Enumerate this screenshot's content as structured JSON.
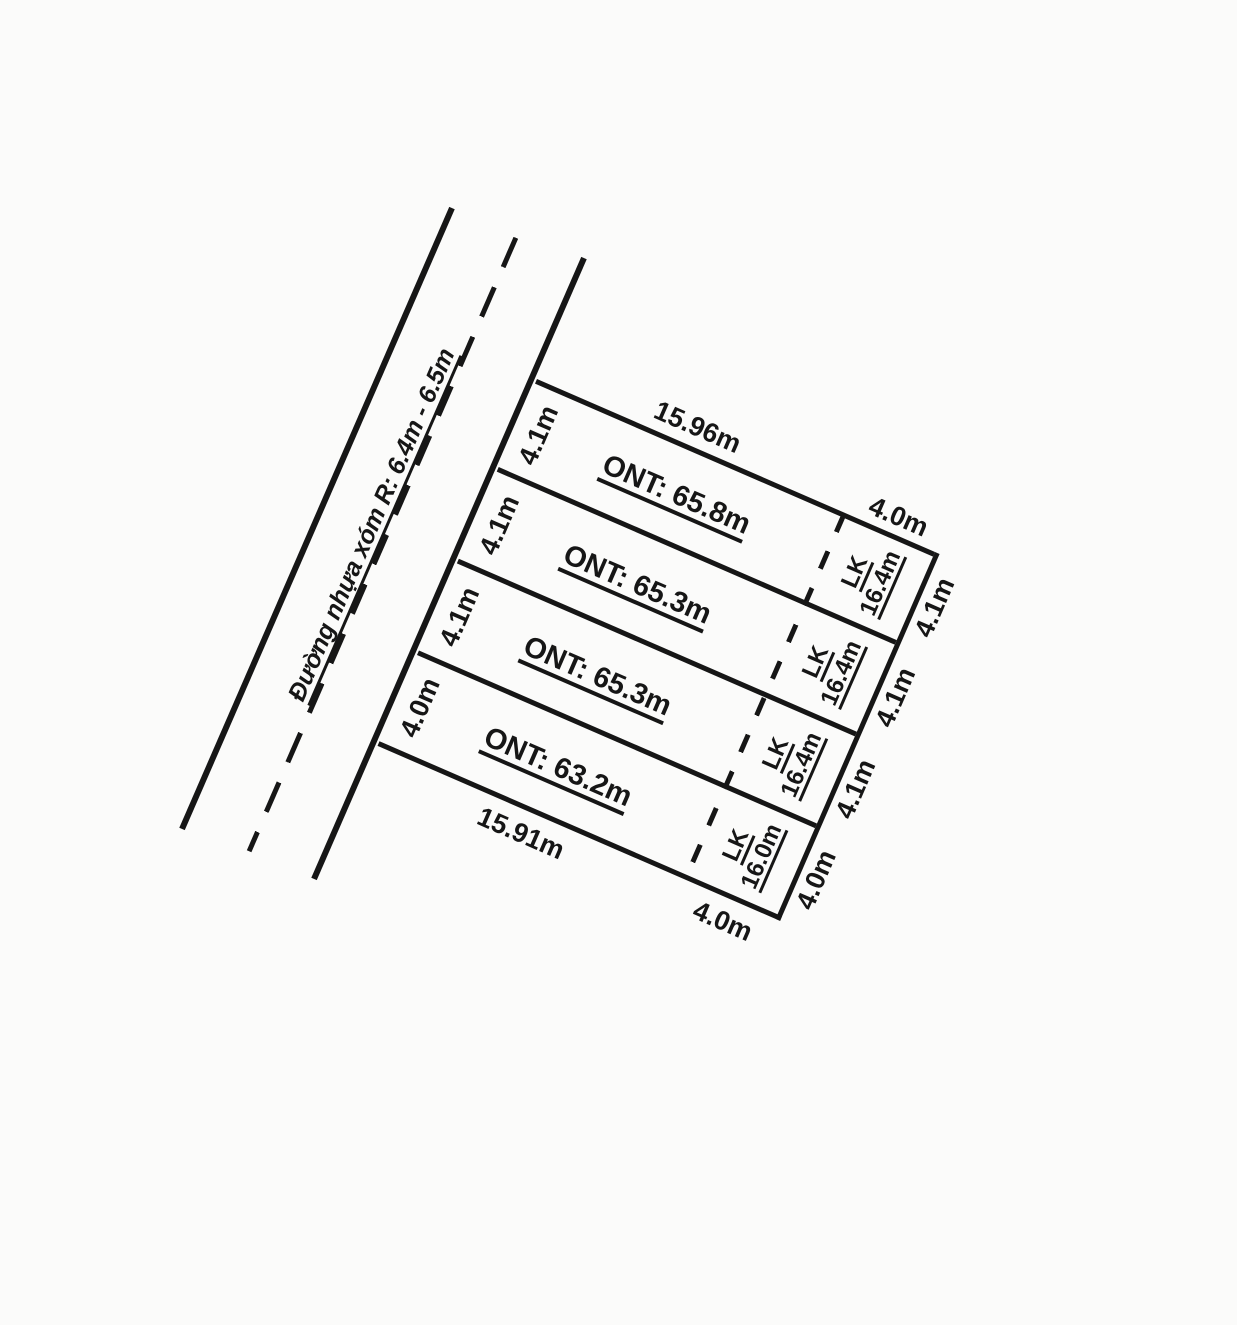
{
  "scene": {
    "background": "#fbfbfa",
    "ink": "#161616",
    "description": "Cadastral sketch of four land plots fronting a village road"
  },
  "road": {
    "label": "Đường nhựa xóm R: 6.4m - 6.5m"
  },
  "plots": [
    {
      "ont_label": "ONT: 65.8m",
      "width_road": "4.1m",
      "width_right": "4.1m",
      "lk_line1": "LK",
      "lk_line2": "16.4m",
      "top_ont": "15.96m",
      "top_lk": "4.0m"
    },
    {
      "ont_label": "ONT: 65.3m",
      "width_road": "4.1m",
      "width_right": "4.1m",
      "lk_line1": "LK",
      "lk_line2": "16.4m"
    },
    {
      "ont_label": "ONT: 65.3m",
      "width_road": "4.1m",
      "width_right": "4.1m",
      "lk_line1": "LK",
      "lk_line2": "16.4m"
    },
    {
      "ont_label": "ONT: 63.2m",
      "width_road": "4.0m",
      "width_right": "4.0m",
      "lk_line1": "LK",
      "lk_line2": "16.0m",
      "bottom_ont": "15.91m",
      "bottom_lk": "4.0m"
    }
  ]
}
